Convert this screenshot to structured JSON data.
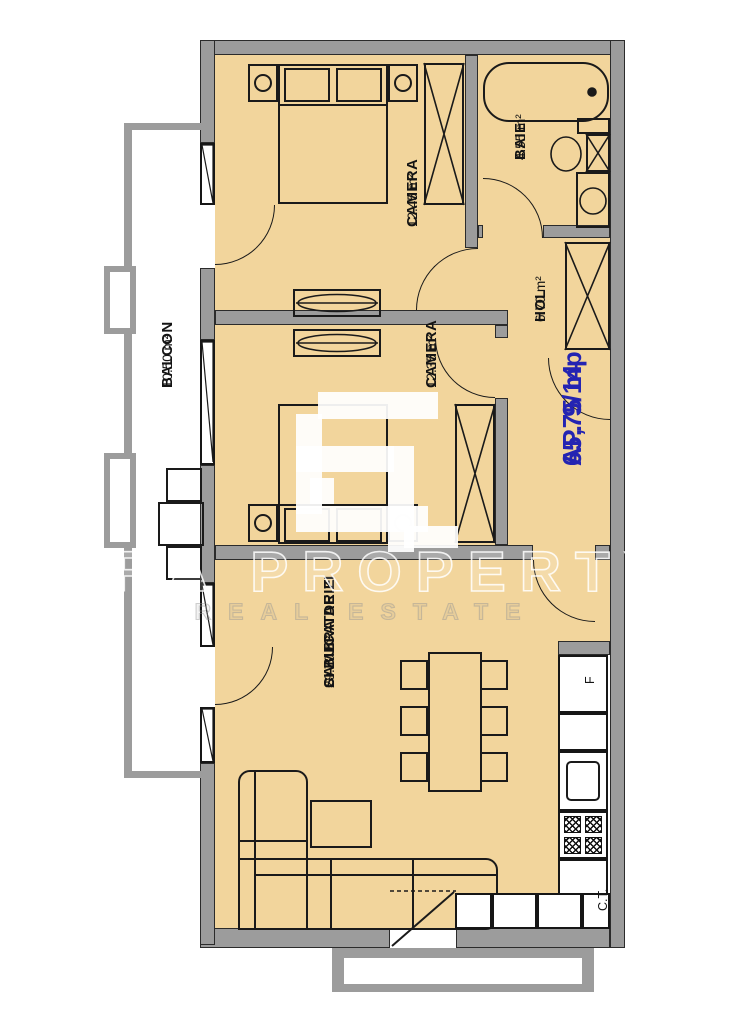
{
  "title": "Apartment floor plan",
  "apartment": {
    "number": "AP. 9/14",
    "area": "65,75 mp"
  },
  "rooms": {
    "bedroom1": {
      "name": "CAMERA",
      "area": "12.45 m²"
    },
    "bathroom": {
      "name": "BAIE",
      "area": "4.55 m²"
    },
    "hall": {
      "name": "HOL",
      "area": "6.70 m²"
    },
    "bedroom2": {
      "name": "CAMERA",
      "area": "12.35 m²"
    },
    "balcony": {
      "name": "BALCON",
      "area": "10.50 m²"
    },
    "living": {
      "name_line1": "CAMERA DE ZI",
      "name_line2": "SI BUCATARIE",
      "area": "29.70 m²"
    }
  },
  "kitchen": {
    "fridge_label": "F",
    "boiler_label": "C.T."
  },
  "watermark": {
    "brand": "ERA PROPERTY",
    "tagline": "REAL ESTATE"
  },
  "colors": {
    "floor": "#f2d59c",
    "wall": "#9c9c9c",
    "line": "#1a1a1a",
    "accent": "#2424b2"
  }
}
